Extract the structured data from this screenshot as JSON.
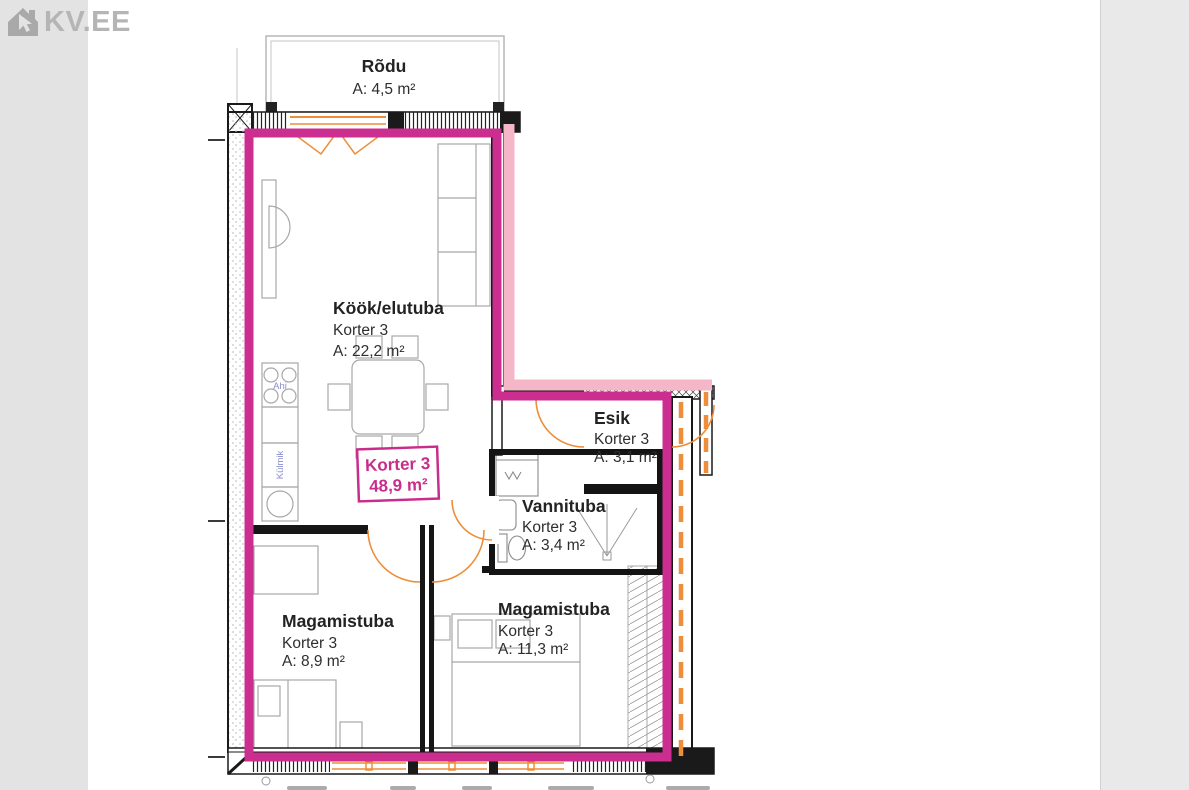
{
  "logo": {
    "text": "KV.EE",
    "icon": "house-cursor-icon",
    "color": "#b5b5b5"
  },
  "unit_badge": {
    "name": "Korter 3",
    "area": "48,9 m²"
  },
  "rooms": [
    {
      "name": "Rõdu",
      "unit": "",
      "area": "A: 4,5 m²"
    },
    {
      "name": "Köök/elutuba",
      "unit": "Korter 3",
      "area": "A: 22,2 m²"
    },
    {
      "name": "Esik",
      "unit": "Korter 3",
      "area": "A: 3,1 m²"
    },
    {
      "name": "Vannituba",
      "unit": "Korter 3",
      "area": "A: 3,4 m²"
    },
    {
      "name": "Magamistuba",
      "unit": "Korter 3",
      "area": "A: 8,9 m²"
    },
    {
      "name": "Magamistuba",
      "unit": "Korter 3",
      "area": "A: 11,3 m²"
    }
  ],
  "fixtures": {
    "stove": "Ahi",
    "fridge": "Külmik"
  },
  "colors": {
    "unit_outline": "#cc2e90",
    "unit_outline_light": "#f5b6c8",
    "doors_windows": "#ee8e3a",
    "walls": "#1a1a1a",
    "furniture": "#a8a8a8",
    "fixture_labels": "#888dd0",
    "badge_text": "#c92d8c"
  }
}
